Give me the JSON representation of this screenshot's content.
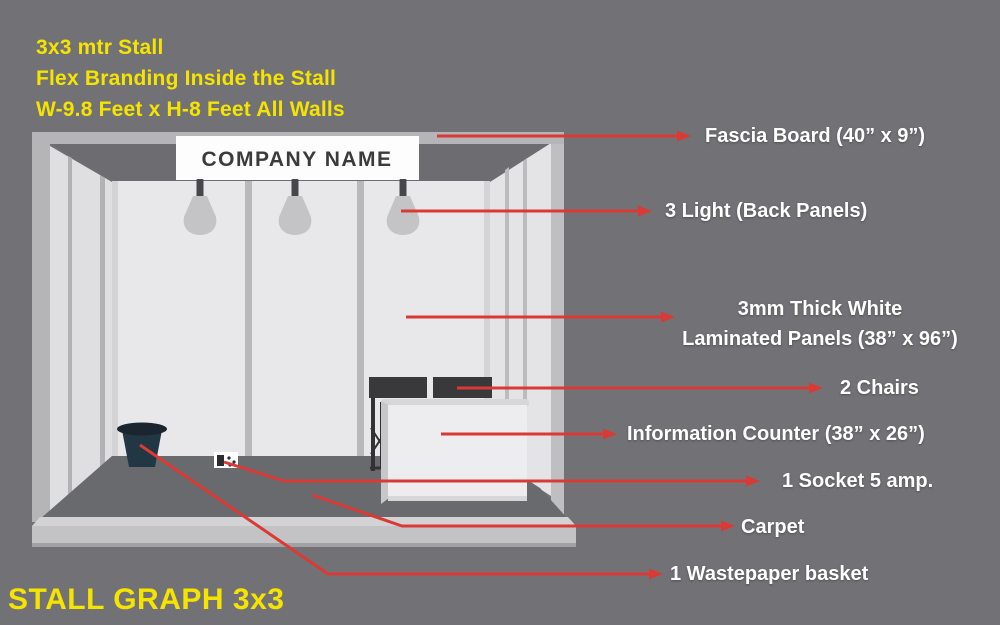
{
  "header": {
    "line1": "3x3 mtr Stall",
    "line2": "Flex Branding Inside the Stall",
    "line3": "W-9.8 Feet x H-8 Feet All Walls"
  },
  "footer": {
    "title": "STALL GRAPH 3x3"
  },
  "stall": {
    "fascia_text": "COMPANY NAME"
  },
  "annotations": {
    "fascia": "Fascia Board (40” x 9”)",
    "lights": "3 Light (Back Panels)",
    "panels_line1": "3mm Thick White",
    "panels_line2": "Laminated Panels (38” x 96”)",
    "chairs": "2 Chairs",
    "counter": "Information Counter (38” x 26”)",
    "socket": "1 Socket 5 amp.",
    "carpet": "Carpet",
    "wastebasket": "1 Wastepaper basket"
  },
  "colors": {
    "background": "#727276",
    "accent_yellow": "#f5e400",
    "arrow_red": "#d93a35",
    "label_white": "#ffffff",
    "carpet_gray": "#696a6e",
    "panel_light": "#e8e8ea",
    "basket_navy": "#213744"
  }
}
